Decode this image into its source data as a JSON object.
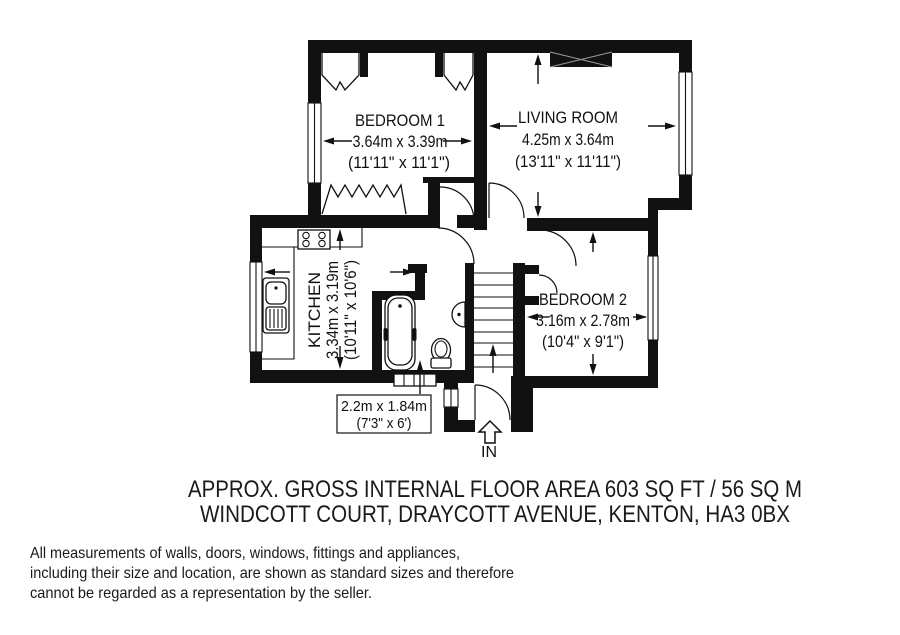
{
  "plan": {
    "bedroom1": {
      "name": "BEDROOM 1",
      "metric": "3.64m x 3.39m",
      "imperial": "(11'11\" x 11'1\")"
    },
    "living_room": {
      "name": "LIVING ROOM",
      "metric": "4.25m x 3.64m",
      "imperial": "(13'11\" x 11'11\")"
    },
    "kitchen": {
      "name": "KITCHEN",
      "metric": "3.34m x 3.19m",
      "imperial": "(10'11\" x 10'6\")"
    },
    "bedroom2": {
      "name": "BEDROOM 2",
      "metric": "3.16m x 2.78m",
      "imperial": "(10'4\" x 9'1\")"
    },
    "bathroom": {
      "metric": "2.2m x 1.84m",
      "imperial": "(7'3\" x 6')"
    },
    "entrance": {
      "label": "IN"
    }
  },
  "footer": {
    "area_line": "APPROX. GROSS INTERNAL FLOOR AREA 603 SQ FT / 56 SQ M",
    "address_line": "WINDCOTT COURT, DRAYCOTT AVENUE, KENTON, HA3 0BX"
  },
  "disclaimer": {
    "line1": "All measurements of walls, doors, windows, fittings and appliances,",
    "line2": "including their size and location, are shown as standard sizes and therefore",
    "line3": "cannot be regarded as a representation by the seller."
  },
  "colors": {
    "ink": "#111111",
    "paper": "#ffffff"
  }
}
